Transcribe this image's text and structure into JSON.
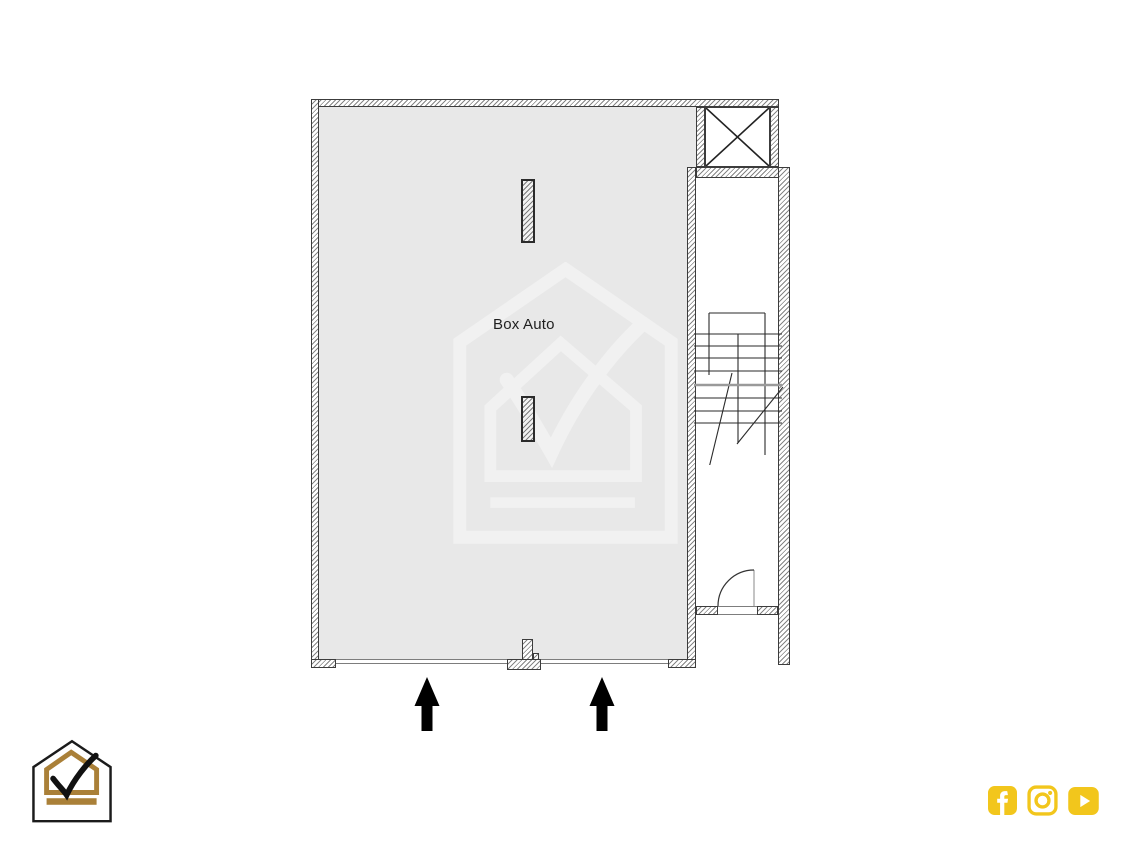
{
  "page": {
    "background_color": "#ffffff"
  },
  "floor_plan": {
    "room_label": "Box Auto",
    "room_fill_color": "#e8e8e8",
    "wall_outline_color": "#3c3c3c",
    "wall_hatch_color": "#858585",
    "elements": {
      "elevator_shaft": "crossed-box",
      "staircase": "stair-run-with-break-lines",
      "stair_door": "quarter-circle-swing",
      "pillar_count": 2,
      "garage_entrance_count": 2
    }
  },
  "entrance_arrows": {
    "count": 2,
    "direction": "up",
    "color": "#000000"
  },
  "watermark": {
    "name": "house-checkmark-watermark",
    "color": "#f1f1f1"
  },
  "branding": {
    "logo_name": "house-checkmark-logo",
    "outline_color": "#1b1b1b",
    "gold_color": "#aa8038"
  },
  "social": {
    "accent_color": "#f2c61c",
    "icons": [
      {
        "name": "facebook-icon"
      },
      {
        "name": "instagram-icon"
      },
      {
        "name": "youtube-icon"
      }
    ]
  }
}
